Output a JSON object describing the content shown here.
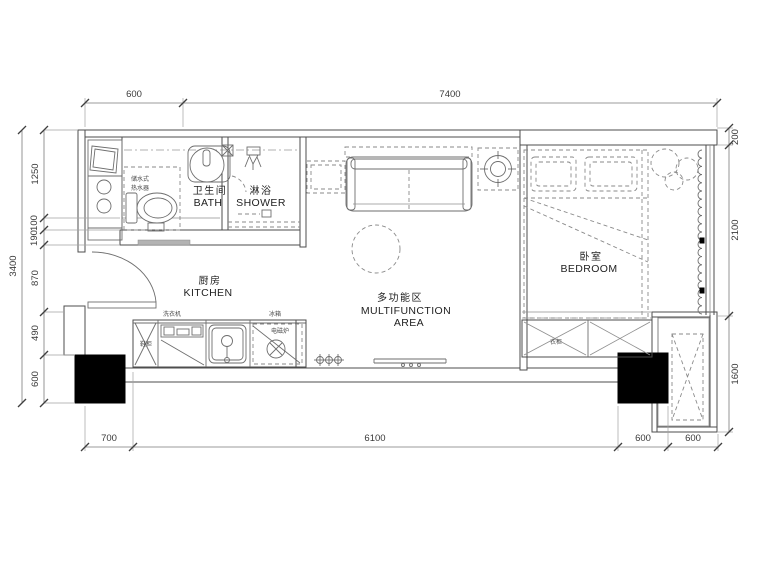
{
  "plan": {
    "rooms": {
      "bath": {
        "zh": "卫生间",
        "en": "BATH"
      },
      "shower": {
        "zh": "淋浴",
        "en": "SHOWER"
      },
      "kitchen": {
        "zh": "厨房",
        "en": "KITCHEN"
      },
      "multifunction": {
        "zh": "多功能区",
        "en_line1": "MULTIFUNCTION",
        "en_line2": "AREA"
      },
      "bedroom": {
        "zh": "卧室",
        "en": "BEDROOM"
      }
    },
    "fixtures": {
      "water_heater_line1": "储水式",
      "water_heater_line2": "热水器",
      "washing_machine": "洗衣机",
      "fridge": "冰箱",
      "induction_cooker": "电磁炉",
      "shoe_cabinet": "鞋柜",
      "wardrobe": "衣柜"
    },
    "dimensions": {
      "top": [
        "600",
        "7400"
      ],
      "left_total": "3400",
      "left": [
        "1250",
        "100",
        "190",
        "870",
        "490",
        "600"
      ],
      "right": [
        "200",
        "2100",
        "1600"
      ],
      "bottom": [
        "700",
        "6100",
        "600",
        "600"
      ]
    }
  }
}
